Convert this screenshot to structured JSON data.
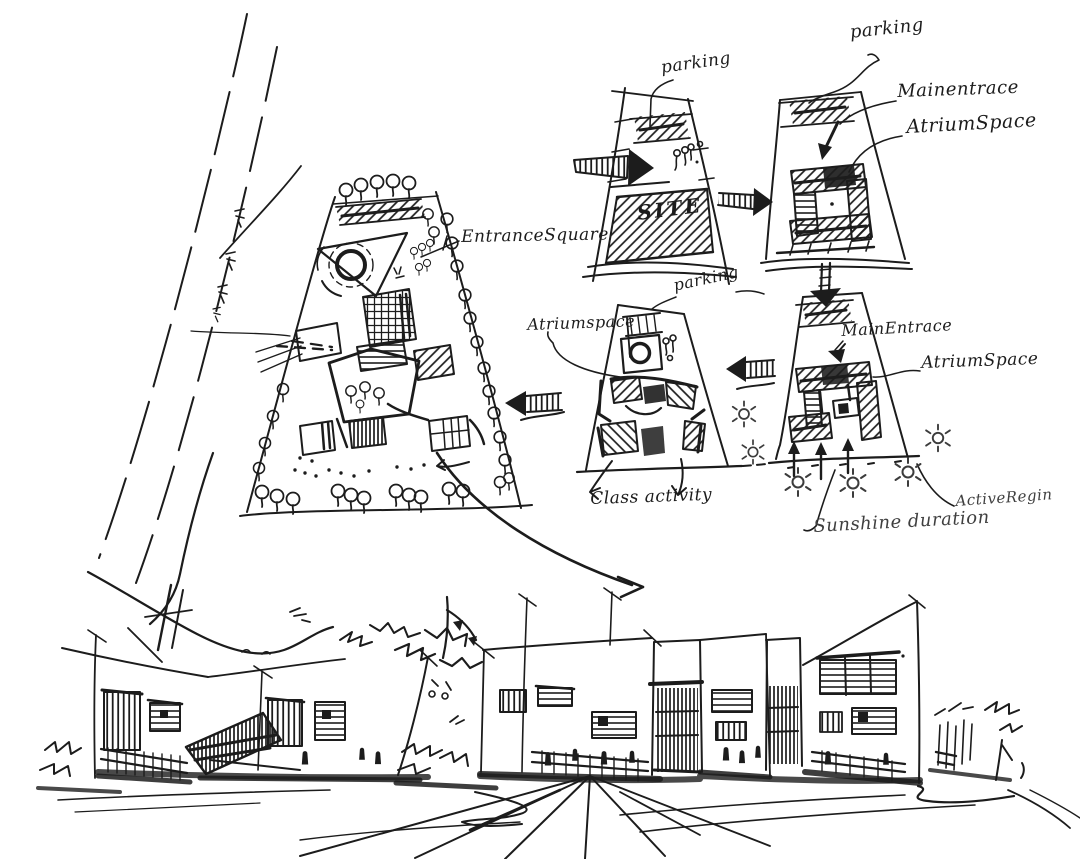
{
  "canvas": {
    "paper_color": "#ffffff",
    "ink_color": "#1c1c1c",
    "soft_ink_color": "#3c3c3c"
  },
  "sketch": {
    "master_plan": {
      "entrance_square_label": "EntranceSquare"
    },
    "site_diagram": {
      "parking_label": "parking",
      "site_label": "SITE"
    },
    "massing_diagram": {
      "parking_label": "parking",
      "main_entrance_label": "Mainentrace",
      "atrium_space_label": "AtriumSpace"
    },
    "sunlight_diagram": {
      "main_entrance_label": "MainEntrace",
      "atrium_space_label": "AtriumSpace",
      "sunshine_duration_label": "Sunshine duration",
      "active_region_label": "ActiveRegin"
    },
    "courtyard_diagram": {
      "parking_label": "parking",
      "atrium_space_label": "Atriumspace",
      "class_activity_label": "Class activity"
    }
  }
}
